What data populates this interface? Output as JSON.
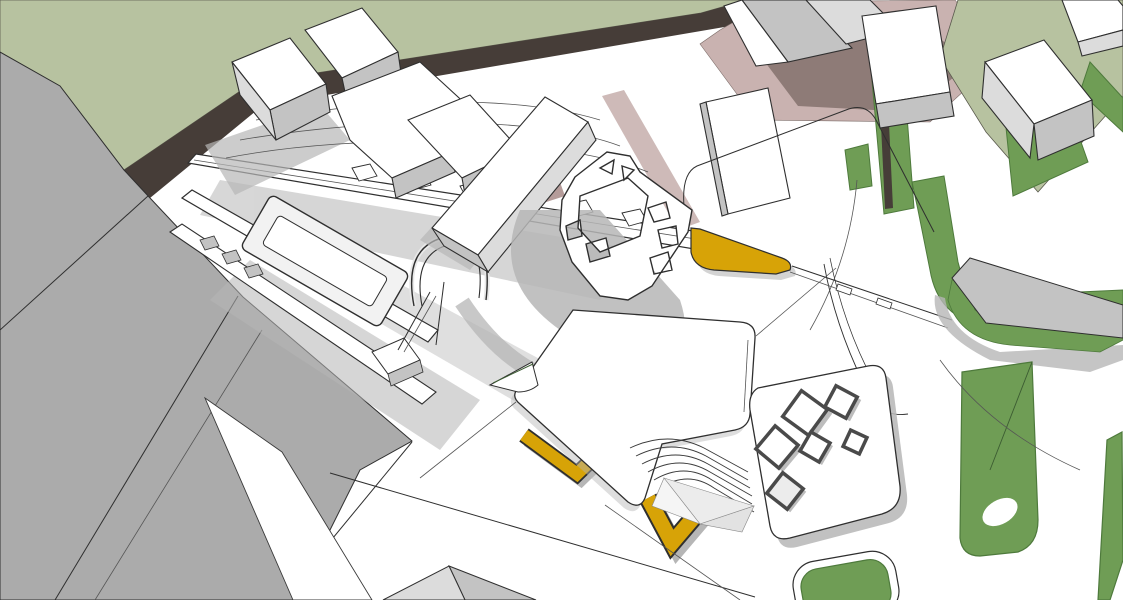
{
  "viewport": {
    "kind": "3d-architectural-massing-model",
    "view": "aerial-perspective",
    "width_px": 1123,
    "height_px": 600
  },
  "palette": {
    "background": "#ffffff",
    "grass_pale": "#b7c2a0",
    "grass_green": "#6f9d55",
    "grass_green_dark": "#4e7a3c",
    "road_dark_band": "#463d38",
    "mauve_light": "#c9b2b0",
    "mauve_mid": "#b59c9a",
    "mauve_dark": "#8e7b77",
    "mass_gray": "#ababab",
    "shadow_gray": "#b6b6b6",
    "face_white": "#ffffff",
    "face_light": "#dcdcdc",
    "face_mid": "#c3c3c3",
    "face_dark": "#9b9b9b",
    "panel_light": "#ececec",
    "accent_gold": "#d7a307",
    "outline_dark": "#2f2f2f"
  },
  "scene": {
    "elements": [
      {
        "name": "grass-field-upper-left",
        "color_key": "grass_pale"
      },
      {
        "name": "dark-road-band",
        "color_key": "road_dark_band"
      },
      {
        "name": "gray-building-mass-left",
        "color_key": "mass_gray"
      },
      {
        "name": "mauve-road-top",
        "color_key": "mauve_light"
      },
      {
        "name": "grass-field-upper-right",
        "color_key": "grass_pale"
      },
      {
        "name": "hedge-bands-right",
        "color_key": "grass_green"
      },
      {
        "name": "white-building-cluster-top",
        "color_key": "face_white"
      },
      {
        "name": "market-walkway-structure",
        "color_key": "face_white"
      },
      {
        "name": "arch-structure",
        "color_key": "face_white"
      },
      {
        "name": "perforated-canopy",
        "color_key": "face_white"
      },
      {
        "name": "gold-landscape-ribbons",
        "color_key": "accent_gold"
      },
      {
        "name": "central-plaza-plate",
        "color_key": "face_white"
      },
      {
        "name": "terraced-steps",
        "color_key": "outline_dark"
      },
      {
        "name": "skylight-squares",
        "color_key": "face_white"
      },
      {
        "name": "gray-slab-right",
        "color_key": "face_mid"
      },
      {
        "name": "park-shapes-bottom-right",
        "color_key": "grass_green"
      }
    ]
  }
}
